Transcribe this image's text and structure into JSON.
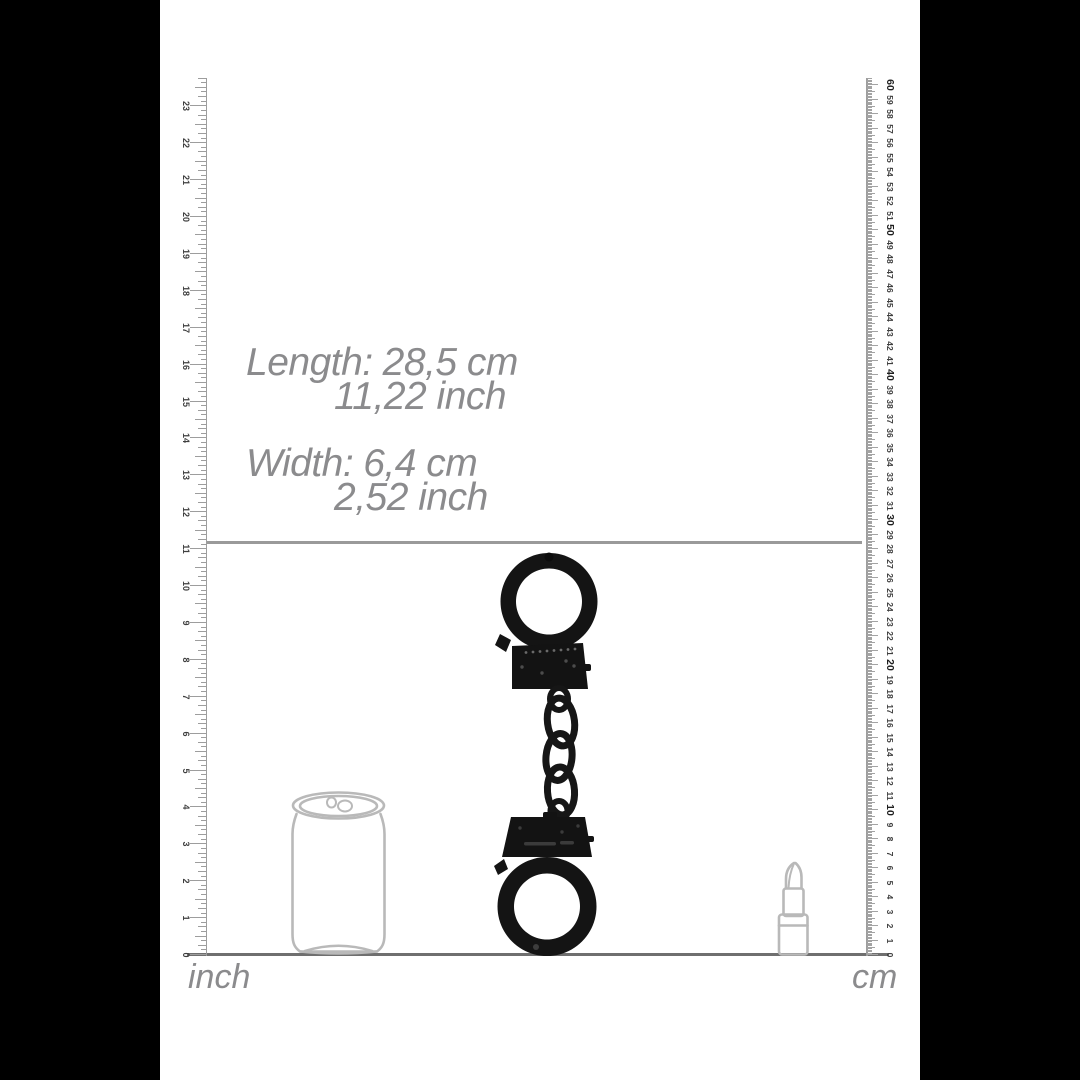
{
  "product_dimensions": {
    "length_label": "Length:",
    "length_metric": "28,5 cm",
    "length_imperial": "11,22 inch",
    "width_label": "Width:",
    "width_metric": "6,4 cm",
    "width_imperial": "2,52 inch"
  },
  "rulers": {
    "inch": {
      "unit_label": "inch",
      "min": 0,
      "max": 23
    },
    "cm": {
      "unit_label": "cm",
      "min": 0,
      "max": 60
    }
  },
  "scale_objects": {
    "left": "soda-can",
    "center": "black-handcuffs",
    "right": "lipstick"
  },
  "colors": {
    "background": "#000000",
    "canvas": "#ffffff",
    "text_gray": "#8b8b8d",
    "ruler_gray": "#9d9d9d",
    "ruler_number": "#3f3f3f",
    "object_outline": "#b9b9b9",
    "product_black": "#141414",
    "length_line": "#9a9a9a",
    "baseline": "#6f6f6f"
  }
}
